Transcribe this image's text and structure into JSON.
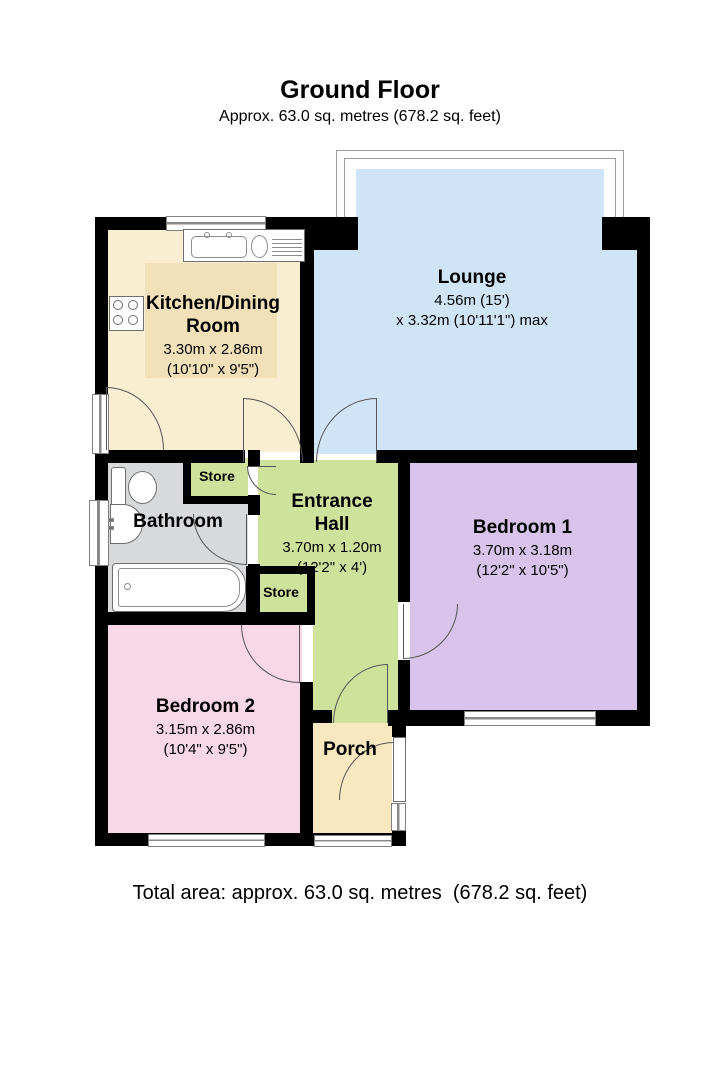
{
  "title": {
    "heading": "Ground Floor",
    "subheading": "Approx. 63.0 sq. metres (678.2 sq. feet)"
  },
  "footer": {
    "text": "Total area: approx. 63.0 sq. metres  (678.2 sq. feet)"
  },
  "rooms": {
    "lounge": {
      "name": "Lounge",
      "line1": "4.56m (15')",
      "line2": "x 3.32m (10'11'1\") max"
    },
    "kitchen": {
      "name": "Kitchen/Dining Room",
      "line1": "3.30m x 2.86m",
      "line2": "(10'10\" x 9'5\")"
    },
    "hall": {
      "name": "Entrance Hall",
      "line1": "3.70m x 1.20m",
      "line2": "(12'2\" x 4')"
    },
    "bedroom1": {
      "name": "Bedroom 1",
      "line1": "3.70m x 3.18m",
      "line2": "(12'2\" x 10'5\")"
    },
    "bedroom2": {
      "name": "Bedroom 2",
      "line1": "3.15m x 2.86m",
      "line2": "(10'4\" x 9'5\")"
    },
    "bathroom": {
      "name": "Bathroom"
    },
    "porch": {
      "name": "Porch"
    },
    "store_top": {
      "name": "Store"
    },
    "store_bottom": {
      "name": "Store"
    }
  },
  "colors": {
    "wall": "#000000",
    "lounge": "#cfe5f7",
    "kitchen": "#f9edd2",
    "kitchen_table": "#f2e0b8",
    "hall": "#cfe29c",
    "bedroom1": "#d8c4ea",
    "bedroom2": "#f8d7e7",
    "bathroom": "#d7d9db",
    "porch": "#f9e7c0"
  }
}
